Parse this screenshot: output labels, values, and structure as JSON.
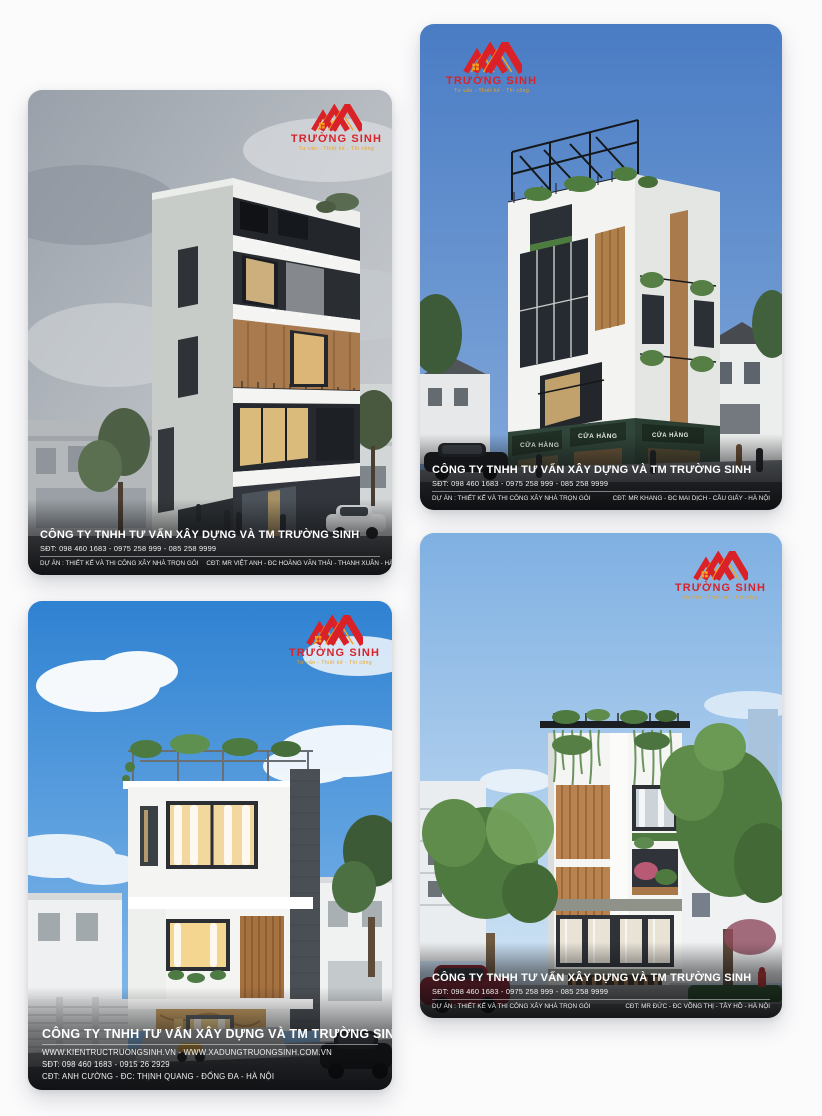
{
  "logo": {
    "name": "TRƯỜNG SINH",
    "tagline": "Tư vấn - Thiết kế - Thi công",
    "red": "#d8232a",
    "orange": "#f5a31d"
  },
  "cards": [
    {
      "title": "CÔNG TY TNHH TƯ VẤN XÂY DỰNG VÀ TM TRƯỜNG SINH",
      "phone": "SĐT: 098 460 1683 - 0975 258 999 - 085 258 9999",
      "project": "DỰ ÁN : THIẾT KẾ VÀ THI CÔNG XÂY NHÀ TRỌN GÓI",
      "owner": "CĐT: MR VIỆT ANH - ĐC HOÀNG VĂN THÁI - THANH XUÂN - HÀ NỘI"
    },
    {
      "title": "CÔNG TY TNHH TƯ VẤN XÂY DỰNG VÀ TM TRƯỜNG SINH",
      "phone": "SĐT: 098 460 1683 - 0975 258 999 - 085 258 9999",
      "project": "DỰ ÁN : THIẾT KẾ VÀ THI CÔNG XÂY NHÀ TRỌN GÓI",
      "owner": "CĐT: MR KHANG - ĐC MAI DỊCH - CẦU GIẤY - HÀ NỘI",
      "shop_sign": "CỬA HÀNG"
    },
    {
      "title": "CÔNG TY TNHH TƯ VẤN XÂY DỰNG VÀ TM TRƯỜNG SINH",
      "websites": "WWW.KIENTRUCTRUONGSINH.VN -  WWW.XADUNGTRUONGSINH.COM.VN",
      "phone": "SĐT: 098 460 1683 - 0915 26 2929",
      "owner": "CĐT: ANH CƯỜNG - ĐC: THỊNH QUANG - ĐỐNG ĐA - HÀ NỘI"
    },
    {
      "title": "CÔNG TY TNHH TƯ VẤN XÂY DỰNG VÀ TM TRƯỜNG SINH",
      "phone": "SĐT: 098 460 1683 - 0975 258 999 - 085 258 9999",
      "project": "DỰ ÁN : THIẾT KẾ VÀ THI CÔNG XÂY NHÀ TRỌN GÓI",
      "owner": "CĐT: MR ĐỨC - ĐC VÕNG THỊ - TÂY HỒ - HÀ NỘI"
    }
  ]
}
